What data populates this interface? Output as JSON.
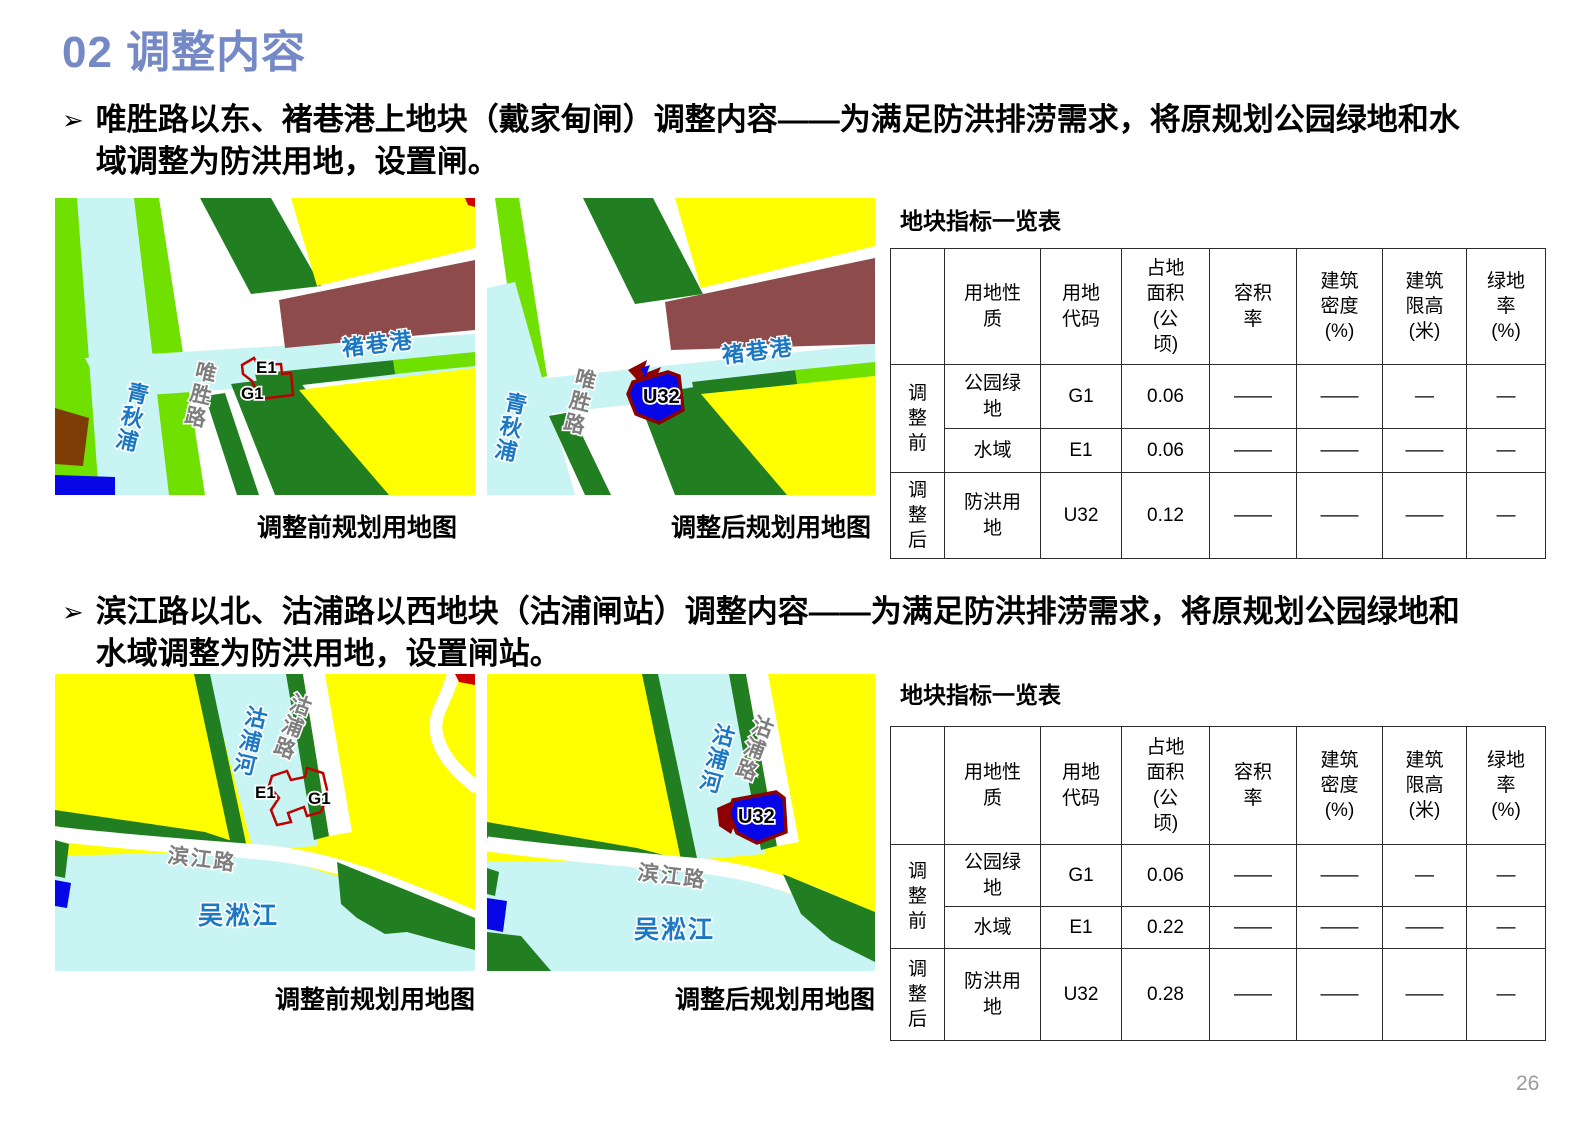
{
  "title": "02 调整内容",
  "page_number": "26",
  "bullets": [
    {
      "marker": "➢",
      "text": "唯胜路以东、褚巷港上地块（戴家甸闸）调整内容——为满足防洪排涝需求，将原规划公园绿地和水域调整为防洪用地，设置闸。"
    },
    {
      "marker": "➢",
      "text": "滨江路以北、沽浦路以西地块（沽浦闸站）调整内容——为满足防洪排涝需求，将原规划公园绿地和水域调整为防洪用地，设置闸站。"
    }
  ],
  "maps": {
    "m1": {
      "caption": "调整前规划用地图",
      "labels": {
        "river_vertical": "青秋浦",
        "road": "唯胜路",
        "river_horizontal": "褚巷港",
        "parcel_e1": "E1",
        "parcel_g1": "G1"
      }
    },
    "m2": {
      "caption": "调整后规划用地图",
      "labels": {
        "river_vertical": "青秋浦",
        "road": "唯胜路",
        "river_horizontal": "褚巷港",
        "parcel_u32": "U32"
      }
    },
    "m3": {
      "caption": "调整前规划用地图",
      "labels": {
        "river_vertical": "沽浦河",
        "road_vertical": "沽浦路",
        "road_horizontal": "滨江路",
        "river_south": "吴淞江",
        "parcel_e1": "E1",
        "parcel_g1": "G1"
      }
    },
    "m4": {
      "caption": "调整后规划用地图",
      "labels": {
        "river_vertical": "沽浦河",
        "road_vertical": "沽浦路",
        "road_horizontal": "滨江路",
        "river_south": "吴淞江",
        "parcel_u32": "U32"
      }
    }
  },
  "table1": {
    "title": "地块指标一览表",
    "headers": [
      "",
      "用地性\n质",
      "用地\n代码",
      "占地\n面积\n(公\n顷)",
      "容积\n率",
      "建筑\n密度\n(%)",
      "建筑\n限高\n(米)",
      "绿地\n率\n(%)"
    ],
    "groups": [
      "调\n整\n前",
      "调\n整\n后"
    ],
    "rows": [
      {
        "nature": "公园绿\n地",
        "code": "G1",
        "area": "0.06",
        "far": "——",
        "density": "——",
        "height_limit": "—",
        "green_rate": "—"
      },
      {
        "nature": "水域",
        "code": "E1",
        "area": "0.06",
        "far": "——",
        "density": "——",
        "height_limit": "——",
        "green_rate": "—"
      },
      {
        "nature": "防洪用\n地",
        "code": "U32",
        "area": "0.12",
        "far": "——",
        "density": "——",
        "height_limit": "——",
        "green_rate": "—"
      }
    ]
  },
  "table2": {
    "title": "地块指标一览表",
    "headers": [
      "",
      "用地性\n质",
      "用地\n代码",
      "占地\n面积\n(公\n顷)",
      "容积\n率",
      "建筑\n密度\n(%)",
      "建筑\n限高\n(米)",
      "绿地\n率\n(%)"
    ],
    "groups": [
      "调\n整\n前",
      "调\n整\n后"
    ],
    "rows": [
      {
        "nature": "公园绿\n地",
        "code": "G1",
        "area": "0.06",
        "far": "——",
        "density": "——",
        "height_limit": "—",
        "green_rate": "—"
      },
      {
        "nature": "水域",
        "code": "E1",
        "area": "0.22",
        "far": "——",
        "density": "——",
        "height_limit": "——",
        "green_rate": "—"
      },
      {
        "nature": "防洪用\n地",
        "code": "U32",
        "area": "0.28",
        "far": "——",
        "density": "——",
        "height_limit": "——",
        "green_rate": "—"
      }
    ]
  },
  "colors": {
    "title_accent": "#7589C6",
    "yellow_landuse": "#FFFF00",
    "park_green": "#70E000",
    "protective_green": "#217E21",
    "water": "#C9F4F4",
    "maroon_landuse": "#8E4B4B",
    "brown_landuse": "#7E3D05",
    "parcel_blue": "#0606E6",
    "red_outline": "#C00000",
    "dark_red": "#8E0000",
    "water_label": "#1B78C4",
    "road_label": "#7E7E7E"
  }
}
